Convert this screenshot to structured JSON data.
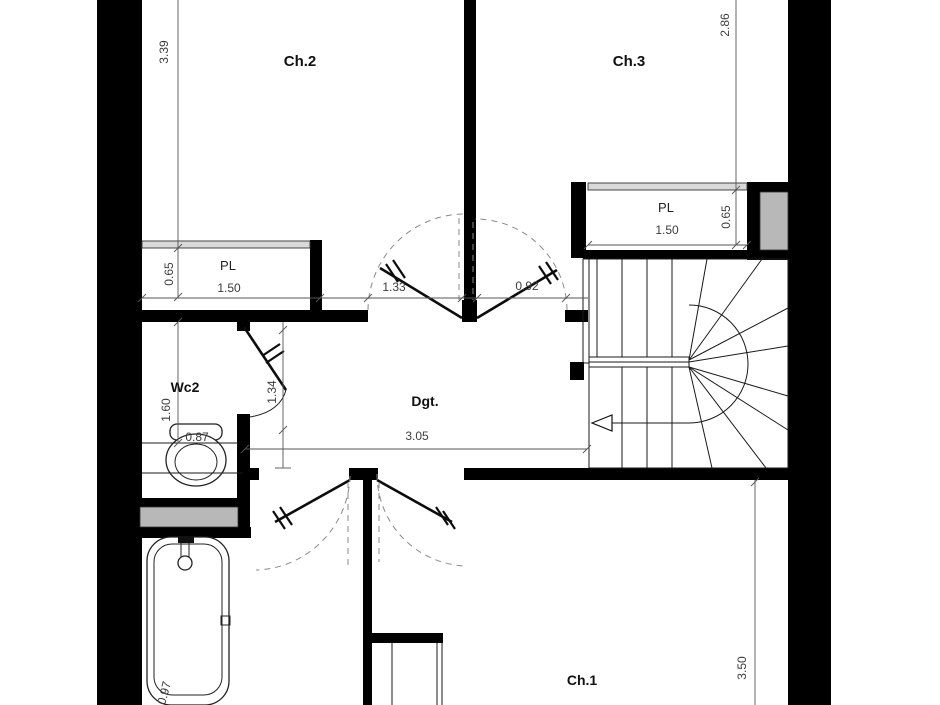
{
  "plan": {
    "room_labels": {
      "ch2": "Ch.2",
      "ch3": "Ch.3",
      "wc2": "Wc2",
      "dgt": "Dgt.",
      "ch1": "Ch.1",
      "pl_left": "PL",
      "pl_right": "PL"
    },
    "dimensions": {
      "ch2_height": "3.39",
      "ch3_height": "2.86",
      "pl_left_depth": "0.65",
      "pl_left_width": "1.50",
      "door_ch2_width": "1.33",
      "door_ch3_width": "0.92",
      "wc2_door": "1.34",
      "wc2_length": "1.60",
      "wc2_width": "0.87",
      "hall_width": "3.05",
      "pl_right_width": "1.50",
      "pl_right_depth": "0.65",
      "ch1_height": "3.50",
      "bath_width": "0.97"
    },
    "colors": {
      "wall": "#000000",
      "line": "#1a1a1a",
      "dim": "#555555",
      "dimtext": "#3c3c3c",
      "gray": "#b8b8b8",
      "light": "#d9d9d9",
      "bg": "#ffffff"
    }
  }
}
